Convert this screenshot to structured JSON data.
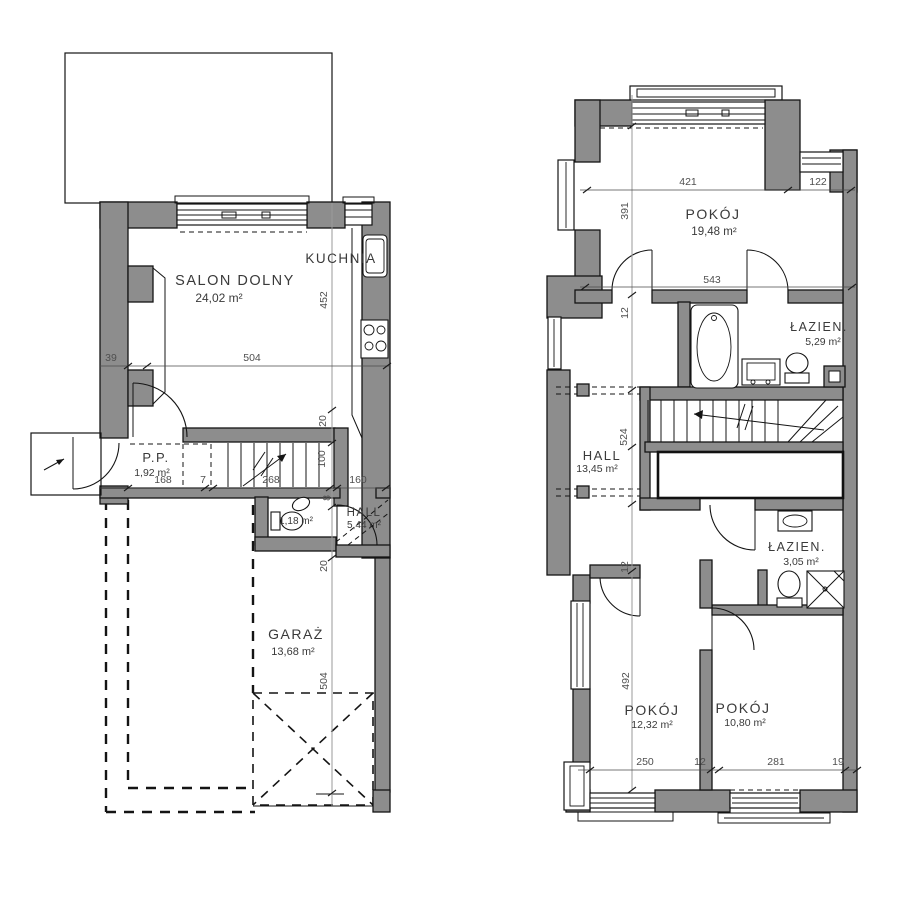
{
  "ground_floor": {
    "rooms": {
      "salon": {
        "label": "SALON DOLNY",
        "area": "24,02 m²"
      },
      "kuchnia": {
        "label": "KUCHNIA"
      },
      "pp": {
        "label": "P.P.",
        "area": "1,92 m²"
      },
      "wc": {
        "area": "1,18 m²"
      },
      "hall": {
        "label": "HALL",
        "area": "5,44 m²"
      },
      "garaz": {
        "label": "GARAŻ",
        "area": "13,68 m²"
      }
    },
    "dims": {
      "offset": "39",
      "salon_w": "504",
      "salon_h": "452",
      "pp_w": "168",
      "gap": "7",
      "stair_w": "268",
      "landing_w": "160",
      "flight": "100",
      "wall_a": "8",
      "wall_b": "20",
      "garage_top": "20",
      "garage_h": "504"
    }
  },
  "upper_floor": {
    "rooms": {
      "pokoj1": {
        "label": "POKÓJ",
        "area": "19,48 m²"
      },
      "lazienka1": {
        "label": "ŁAZIEN.",
        "area": "5,29 m²"
      },
      "hall": {
        "label": "HALL",
        "area": "13,45 m²"
      },
      "lazienka2": {
        "label": "ŁAZIEN.",
        "area": "3,05 m²"
      },
      "pokoj2": {
        "label": "POKÓJ",
        "area": "12,32 m²"
      },
      "pokoj3": {
        "label": "POKÓJ",
        "area": "10,80 m²"
      }
    },
    "dims": {
      "pokoj_w": "421",
      "niche_w": "122",
      "pokoj_h": "391",
      "mid_w": "543",
      "wall_top": "12",
      "hall_h": "524",
      "wall_bottom": "12",
      "pokoj_h2": "492",
      "pokoj2_w": "250",
      "wall_mid": "12",
      "pokoj3_w": "281",
      "edge": "19"
    }
  }
}
